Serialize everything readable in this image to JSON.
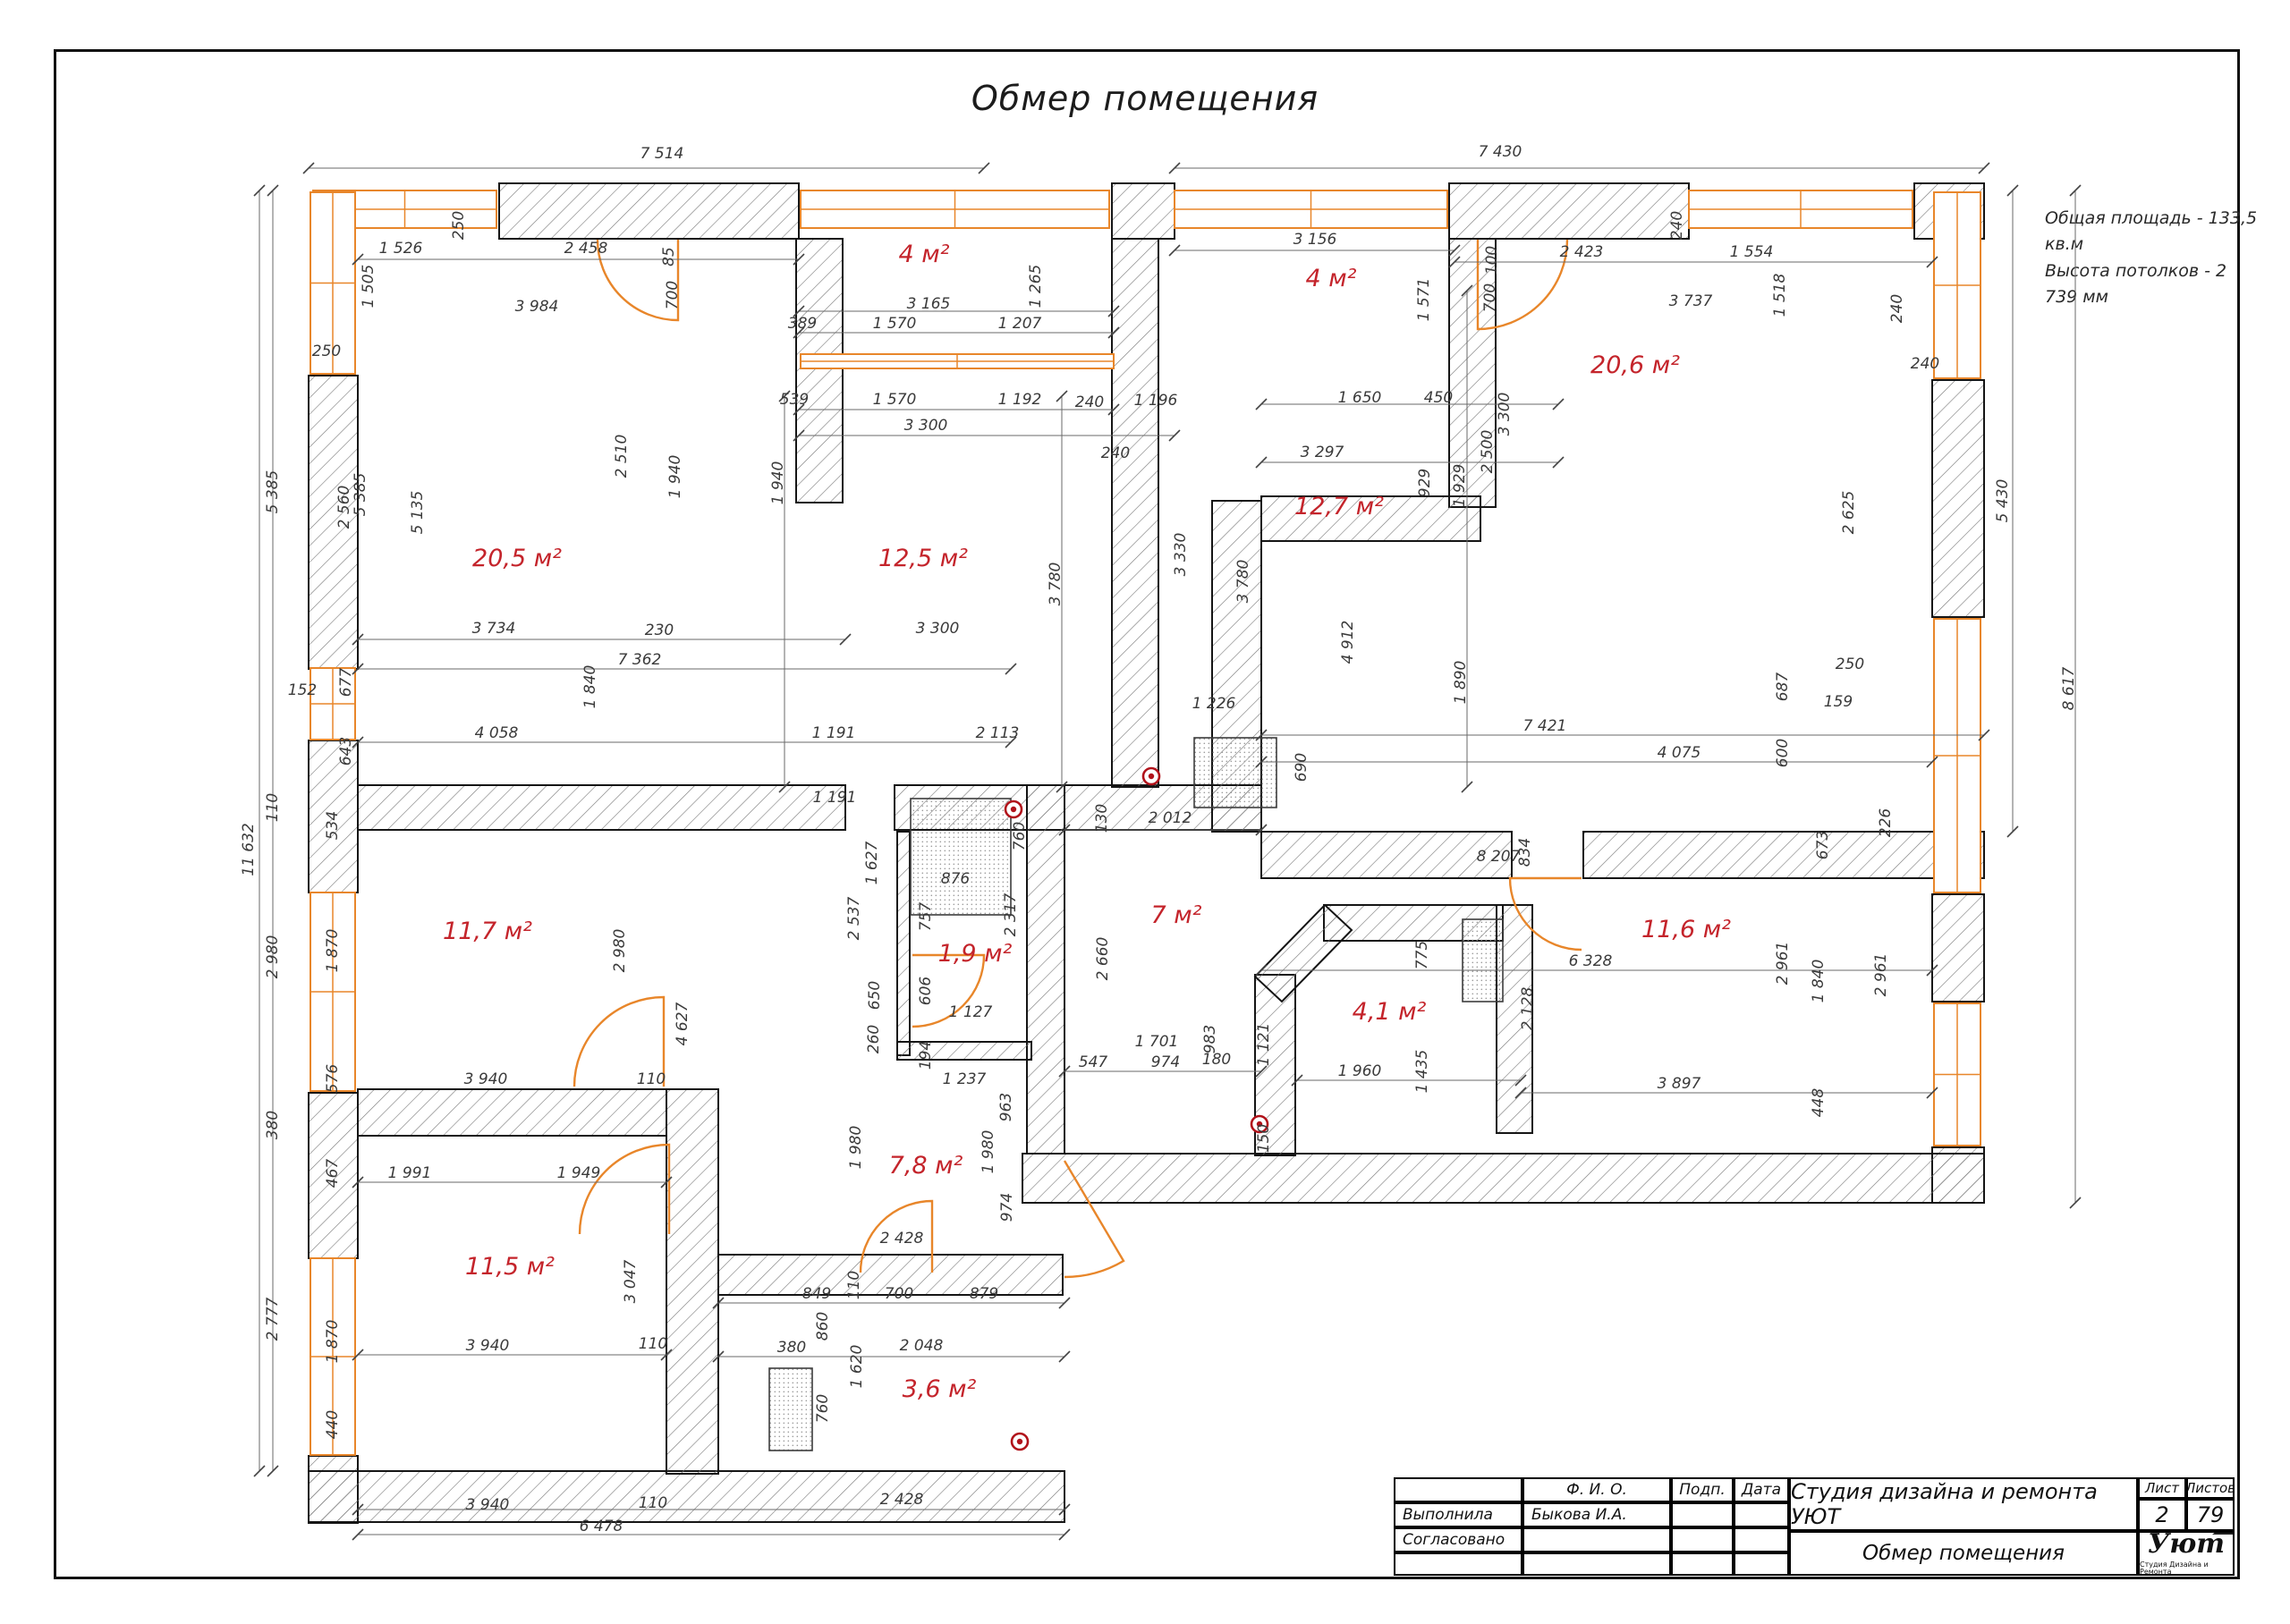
{
  "sheet": {
    "title": "Обмер помещения",
    "note1": "Общая площадь  -  133,5 кв.м",
    "note2": "Высота потолков  -  2 739 мм"
  },
  "title_block": {
    "col_fio": "Ф. И. О.",
    "col_sign": "Подп.",
    "col_date": "Дата",
    "row_done_label": "Выполнила",
    "row_done_name": "Быкова И.А.",
    "row_agreed_label": "Согласовано",
    "company": "Студия дизайна и ремонта УЮТ",
    "sheet_label": "Лист",
    "sheets_label": "Листов",
    "sheet_no": "2",
    "sheets_total": "79",
    "doc_title": "Обмер помещения",
    "logo_text": "Уют",
    "logo_sub": "Студия Дизайна и Ремонта"
  },
  "colors": {
    "wall_stroke": "#151515",
    "hatch": "#787878",
    "window_orange": "#e8862a",
    "dim_line": "#6a6a6a",
    "dim_text": "#3a3a3a",
    "room_red": "#c4242b",
    "outlet_red": "#b1121a"
  },
  "plan": {
    "walls": [
      [
        558,
        205,
        335,
        62
      ],
      [
        1243,
        205,
        70,
        62
      ],
      [
        1620,
        205,
        268,
        62
      ],
      [
        2140,
        205,
        78,
        62
      ],
      [
        1620,
        267,
        52,
        300
      ],
      [
        345,
        420,
        55,
        328
      ],
      [
        345,
        828,
        55,
        170
      ],
      [
        345,
        1222,
        55,
        185
      ],
      [
        345,
        1628,
        55,
        75
      ],
      [
        345,
        1645,
        845,
        57
      ],
      [
        2160,
        425,
        58,
        265
      ],
      [
        2160,
        1000,
        58,
        120
      ],
      [
        2160,
        1283,
        58,
        62
      ],
      [
        1143,
        1290,
        1075,
        55
      ],
      [
        400,
        878,
        545,
        50
      ],
      [
        1000,
        878,
        410,
        50
      ],
      [
        1410,
        930,
        280,
        52
      ],
      [
        1770,
        930,
        448,
        52
      ],
      [
        890,
        267,
        52,
        295
      ],
      [
        1243,
        267,
        52,
        613
      ],
      [
        1355,
        560,
        55,
        370
      ],
      [
        1410,
        555,
        245,
        50
      ],
      [
        1148,
        878,
        42,
        412
      ],
      [
        803,
        1403,
        385,
        45
      ],
      [
        745,
        1218,
        58,
        430
      ],
      [
        400,
        1218,
        345,
        52
      ],
      [
        1403,
        1090,
        45,
        202
      ],
      [
        1480,
        1012,
        200,
        40
      ],
      [
        1673,
        1012,
        40,
        255
      ],
      [
        1003,
        930,
        14,
        250
      ],
      [
        1003,
        1165,
        150,
        20
      ]
    ],
    "wall_polys": [
      [
        [
          1403,
          1092
        ],
        [
          1481,
          1012
        ],
        [
          1511,
          1040
        ],
        [
          1433,
          1120
        ]
      ]
    ],
    "windows": [
      [
        350,
        213,
        205,
        42,
        "h"
      ],
      [
        895,
        213,
        345,
        42,
        "h"
      ],
      [
        1313,
        213,
        305,
        42,
        "h"
      ],
      [
        1888,
        213,
        250,
        42,
        "h"
      ],
      [
        347,
        215,
        50,
        203,
        "v"
      ],
      [
        347,
        747,
        50,
        80,
        "v"
      ],
      [
        347,
        998,
        50,
        222,
        "v"
      ],
      [
        347,
        1407,
        50,
        220,
        "v"
      ],
      [
        2162,
        215,
        52,
        208,
        "v"
      ],
      [
        2162,
        692,
        52,
        306,
        "v"
      ],
      [
        2162,
        1122,
        52,
        159,
        "v"
      ],
      [
        895,
        396,
        350,
        16,
        "h"
      ]
    ],
    "fixtures": [
      [
        1018,
        893,
        112,
        130
      ],
      [
        1635,
        1028,
        45,
        92
      ],
      [
        860,
        1530,
        48,
        92
      ],
      [
        1335,
        825,
        92,
        78
      ]
    ],
    "doors": [
      "M758,268 L758,358 A90,90 0 0 1 668,268",
      "M1652,268 L1652,368 A100,100 0 0 0 1752,268",
      "M742,1215 L742,1115 A100,100 0 0 0 642,1215",
      "M1020,1068 L1100,1068 A80,80 0 0 1 1020,1148",
      "M1042,1423 L1042,1343 A80,80 0 0 0 962,1423",
      "M1190,1298 L1256,1410 A130,130 0 0 1 1190,1428",
      "M1768,982 L1688,982 A80,80 0 0 0 1768,1062",
      "M748,1380 L748,1280 A100,100 0 0 0 648,1380"
    ],
    "outlets": [
      [
        1133,
        905
      ],
      [
        1287,
        868
      ],
      [
        1408,
        1257
      ],
      [
        1140,
        1612
      ]
    ],
    "dimlines": [
      [
        345,
        188,
        1100,
        188
      ],
      [
        1313,
        188,
        2218,
        188
      ],
      [
        400,
        290,
        893,
        290
      ],
      [
        893,
        348,
        1245,
        348
      ],
      [
        893,
        372,
        1245,
        372
      ],
      [
        893,
        458,
        1245,
        458
      ],
      [
        893,
        487,
        1313,
        487
      ],
      [
        1313,
        280,
        1626,
        280
      ],
      [
        1626,
        293,
        2160,
        293
      ],
      [
        1410,
        452,
        1742,
        452
      ],
      [
        1410,
        517,
        1742,
        517
      ],
      [
        400,
        715,
        945,
        715
      ],
      [
        400,
        748,
        1130,
        748
      ],
      [
        400,
        830,
        1130,
        830
      ],
      [
        400,
        1322,
        745,
        1322
      ],
      [
        400,
        1515,
        745,
        1515
      ],
      [
        803,
        1457,
        1190,
        1457
      ],
      [
        803,
        1517,
        1190,
        1517
      ],
      [
        400,
        1688,
        1190,
        1688
      ],
      [
        400,
        1716,
        1190,
        1716
      ],
      [
        1410,
        1085,
        2160,
        1085
      ],
      [
        1700,
        1222,
        2160,
        1222
      ],
      [
        1410,
        822,
        2218,
        822
      ],
      [
        1410,
        852,
        2160,
        852
      ],
      [
        1190,
        928,
        1410,
        928
      ],
      [
        1190,
        1198,
        1410,
        1198
      ],
      [
        1450,
        1208,
        1700,
        1208
      ],
      [
        290,
        213,
        290,
        1645
      ],
      [
        305,
        213,
        305,
        1645
      ],
      [
        2250,
        213,
        2250,
        930
      ],
      [
        2320,
        213,
        2320,
        1345
      ],
      [
        877,
        443,
        877,
        880
      ],
      [
        1187,
        443,
        1187,
        880
      ],
      [
        1640,
        325,
        1640,
        880
      ]
    ],
    "rooms": [
      [
        "4 м²",
        1033,
        293
      ],
      [
        "4 м²",
        1488,
        320
      ],
      [
        "20,6 м²",
        1828,
        417
      ],
      [
        "20,5 м²",
        578,
        633
      ],
      [
        "12,5 м²",
        1032,
        633
      ],
      [
        "12,7 м²",
        1497,
        575
      ],
      [
        "11,7 м²",
        545,
        1050
      ],
      [
        "1,9 м²",
        1090,
        1075
      ],
      [
        "7 м²",
        1315,
        1032
      ],
      [
        "4,1 м²",
        1553,
        1140
      ],
      [
        "11,6 м²",
        1885,
        1048
      ],
      [
        "11,5 м²",
        570,
        1425
      ],
      [
        "7,8 м²",
        1035,
        1312
      ],
      [
        "3,6 м²",
        1050,
        1562
      ]
    ],
    "dims": [
      [
        "7 514",
        740,
        177,
        0
      ],
      [
        "7 430",
        1677,
        175,
        0
      ],
      [
        "5 430",
        2244,
        560,
        -90
      ],
      [
        "8 617",
        2318,
        770,
        -90
      ],
      [
        "11 632",
        283,
        950,
        -90
      ],
      [
        "5 385",
        310,
        550,
        -90
      ],
      [
        "110",
        310,
        903,
        -90
      ],
      [
        "2 980",
        310,
        1070,
        -90
      ],
      [
        "380",
        310,
        1258,
        -90
      ],
      [
        "2 777",
        310,
        1475,
        -90
      ],
      [
        "1 526",
        448,
        283,
        0
      ],
      [
        "2 458",
        655,
        283,
        0
      ],
      [
        "85",
        753,
        287,
        -90
      ],
      [
        "700",
        757,
        330,
        -90
      ],
      [
        "250",
        518,
        252,
        -90
      ],
      [
        "1 505",
        417,
        320,
        -90
      ],
      [
        "3 984",
        600,
        348,
        0
      ],
      [
        "250",
        365,
        398,
        0
      ],
      [
        "5 385",
        408,
        553,
        -90
      ],
      [
        "2 560",
        390,
        567,
        -90
      ],
      [
        "5 135",
        472,
        573,
        -90
      ],
      [
        "2 510",
        700,
        510,
        -90
      ],
      [
        "1 940",
        760,
        533,
        -90
      ],
      [
        "3 734",
        552,
        708,
        0
      ],
      [
        "230",
        737,
        710,
        0
      ],
      [
        "7 362",
        715,
        743,
        0
      ],
      [
        "677",
        392,
        763,
        -90
      ],
      [
        "152",
        338,
        777,
        0
      ],
      [
        "1 840",
        665,
        768,
        -90
      ],
      [
        "643",
        392,
        840,
        -90
      ],
      [
        "4 058",
        555,
        825,
        0
      ],
      [
        "3 165",
        1038,
        345,
        0
      ],
      [
        "389",
        897,
        367,
        0
      ],
      [
        "1 570",
        1000,
        367,
        0
      ],
      [
        "1 207",
        1140,
        367,
        0
      ],
      [
        "1 265",
        1163,
        320,
        -90
      ],
      [
        "539",
        888,
        452,
        0
      ],
      [
        "1 570",
        1000,
        452,
        0
      ],
      [
        "1 192",
        1140,
        452,
        0
      ],
      [
        "240",
        1218,
        455,
        0
      ],
      [
        "1 196",
        1292,
        453,
        0
      ],
      [
        "3 300",
        1035,
        481,
        0
      ],
      [
        "240",
        1247,
        512,
        0
      ],
      [
        "1 940",
        875,
        540,
        -90
      ],
      [
        "3 300",
        1048,
        708,
        0
      ],
      [
        "3 780",
        1185,
        653,
        -90
      ],
      [
        "1 191",
        932,
        825,
        0
      ],
      [
        "2 113",
        1115,
        825,
        0
      ],
      [
        "1 191",
        933,
        897,
        0
      ],
      [
        "3 156",
        1470,
        273,
        0
      ],
      [
        "1 571",
        1597,
        335,
        -90
      ],
      [
        "100",
        1673,
        291,
        -90
      ],
      [
        "700",
        1671,
        333,
        -90
      ],
      [
        "2 423",
        1768,
        287,
        0
      ],
      [
        "1 554",
        1958,
        287,
        0
      ],
      [
        "1 518",
        1995,
        330,
        -90
      ],
      [
        "240",
        1880,
        252,
        -90
      ],
      [
        "240",
        2152,
        412,
        0
      ],
      [
        "1 650",
        1520,
        450,
        0
      ],
      [
        "450",
        1608,
        450,
        0
      ],
      [
        "3 300",
        1687,
        463,
        -90
      ],
      [
        "2 500",
        1668,
        505,
        -90
      ],
      [
        "929",
        1598,
        540,
        -90
      ],
      [
        "3 297",
        1478,
        511,
        0
      ],
      [
        "3 737",
        1890,
        342,
        0
      ],
      [
        "240",
        2126,
        345,
        -90
      ],
      [
        "1 929",
        1637,
        543,
        -90
      ],
      [
        "3 330",
        1325,
        620,
        -90
      ],
      [
        "3 780",
        1395,
        650,
        -90
      ],
      [
        "4 912",
        1512,
        718,
        -90
      ],
      [
        "1 890",
        1638,
        763,
        -90
      ],
      [
        "1 226",
        1357,
        792,
        0
      ],
      [
        "690",
        1460,
        858,
        -90
      ],
      [
        "2 012",
        1308,
        920,
        0
      ],
      [
        "130",
        1237,
        915,
        -90
      ],
      [
        "7 421",
        1727,
        817,
        0
      ],
      [
        "4 075",
        1877,
        847,
        0
      ],
      [
        "687",
        1998,
        768,
        -90
      ],
      [
        "250",
        2068,
        748,
        0
      ],
      [
        "159",
        2055,
        790,
        0
      ],
      [
        "600",
        1998,
        842,
        -90
      ],
      [
        "226",
        2113,
        920,
        -90
      ],
      [
        "673",
        2043,
        945,
        -90
      ],
      [
        "834",
        1710,
        953,
        -90
      ],
      [
        "8 207",
        1675,
        963,
        0
      ],
      [
        "2 625",
        2072,
        573,
        -90
      ],
      [
        "534",
        377,
        923,
        -90
      ],
      [
        "1 870",
        377,
        1063,
        -90
      ],
      [
        "576",
        377,
        1206,
        -90
      ],
      [
        "2 980",
        698,
        1063,
        -90
      ],
      [
        "4 627",
        768,
        1145,
        -90
      ],
      [
        "3 940",
        543,
        1212,
        0
      ],
      [
        "110",
        728,
        1212,
        0
      ],
      [
        "467",
        377,
        1312,
        -90
      ],
      [
        "1 991",
        458,
        1317,
        0
      ],
      [
        "1 949",
        647,
        1317,
        0
      ],
      [
        "1 627",
        980,
        965,
        -90
      ],
      [
        "2 537",
        960,
        1027,
        -90
      ],
      [
        "876",
        1068,
        988,
        0
      ],
      [
        "757",
        1040,
        1025,
        -90
      ],
      [
        "2 317",
        1135,
        1023,
        -90
      ],
      [
        "760",
        1145,
        935,
        -90
      ],
      [
        "606",
        1040,
        1108,
        -90
      ],
      [
        "650",
        983,
        1113,
        -90
      ],
      [
        "260",
        982,
        1162,
        -90
      ],
      [
        "1 127",
        1085,
        1137,
        0
      ],
      [
        "194",
        1040,
        1180,
        -90
      ],
      [
        "963",
        1130,
        1238,
        -90
      ],
      [
        "1 237",
        1078,
        1212,
        0
      ],
      [
        "1 980",
        962,
        1283,
        -90
      ],
      [
        "1 980",
        1110,
        1288,
        -90
      ],
      [
        "974",
        1131,
        1350,
        -90
      ],
      [
        "2 428",
        1008,
        1390,
        0
      ],
      [
        "110",
        960,
        1437,
        -90
      ],
      [
        "2 660",
        1238,
        1072,
        -90
      ],
      [
        "1 701",
        1293,
        1170,
        0
      ],
      [
        "983",
        1358,
        1162,
        -90
      ],
      [
        "547",
        1222,
        1193,
        0
      ],
      [
        "974",
        1303,
        1193,
        0
      ],
      [
        "180",
        1360,
        1190,
        0
      ],
      [
        "775",
        1595,
        1068,
        -90
      ],
      [
        "6 328",
        1778,
        1080,
        0
      ],
      [
        "2 128",
        1713,
        1128,
        -90
      ],
      [
        "1 121",
        1418,
        1168,
        -90
      ],
      [
        "1 960",
        1520,
        1203,
        0
      ],
      [
        "1 435",
        1595,
        1198,
        -90
      ],
      [
        "150",
        1418,
        1273,
        -90
      ],
      [
        "2 961",
        1998,
        1077,
        -90
      ],
      [
        "1 840",
        2038,
        1097,
        -90
      ],
      [
        "2 961",
        2108,
        1090,
        -90
      ],
      [
        "3 897",
        1877,
        1217,
        0
      ],
      [
        "448",
        2038,
        1233,
        -90
      ],
      [
        "3 047",
        710,
        1433,
        -90
      ],
      [
        "1 870",
        377,
        1500,
        -90
      ],
      [
        "440",
        377,
        1593,
        -90
      ],
      [
        "3 940",
        545,
        1510,
        0
      ],
      [
        "110",
        730,
        1508,
        0
      ],
      [
        "849",
        913,
        1452,
        0
      ],
      [
        "700",
        1005,
        1452,
        0
      ],
      [
        "879",
        1100,
        1452,
        0
      ],
      [
        "860",
        925,
        1483,
        -90
      ],
      [
        "380",
        885,
        1512,
        0
      ],
      [
        "2 048",
        1030,
        1510,
        0
      ],
      [
        "1 620",
        963,
        1528,
        -90
      ],
      [
        "760",
        925,
        1575,
        -90
      ],
      [
        "3 940",
        545,
        1688,
        0
      ],
      [
        "110",
        730,
        1686,
        0
      ],
      [
        "2 428",
        1008,
        1682,
        0
      ],
      [
        "6 478",
        672,
        1712,
        0
      ]
    ]
  }
}
